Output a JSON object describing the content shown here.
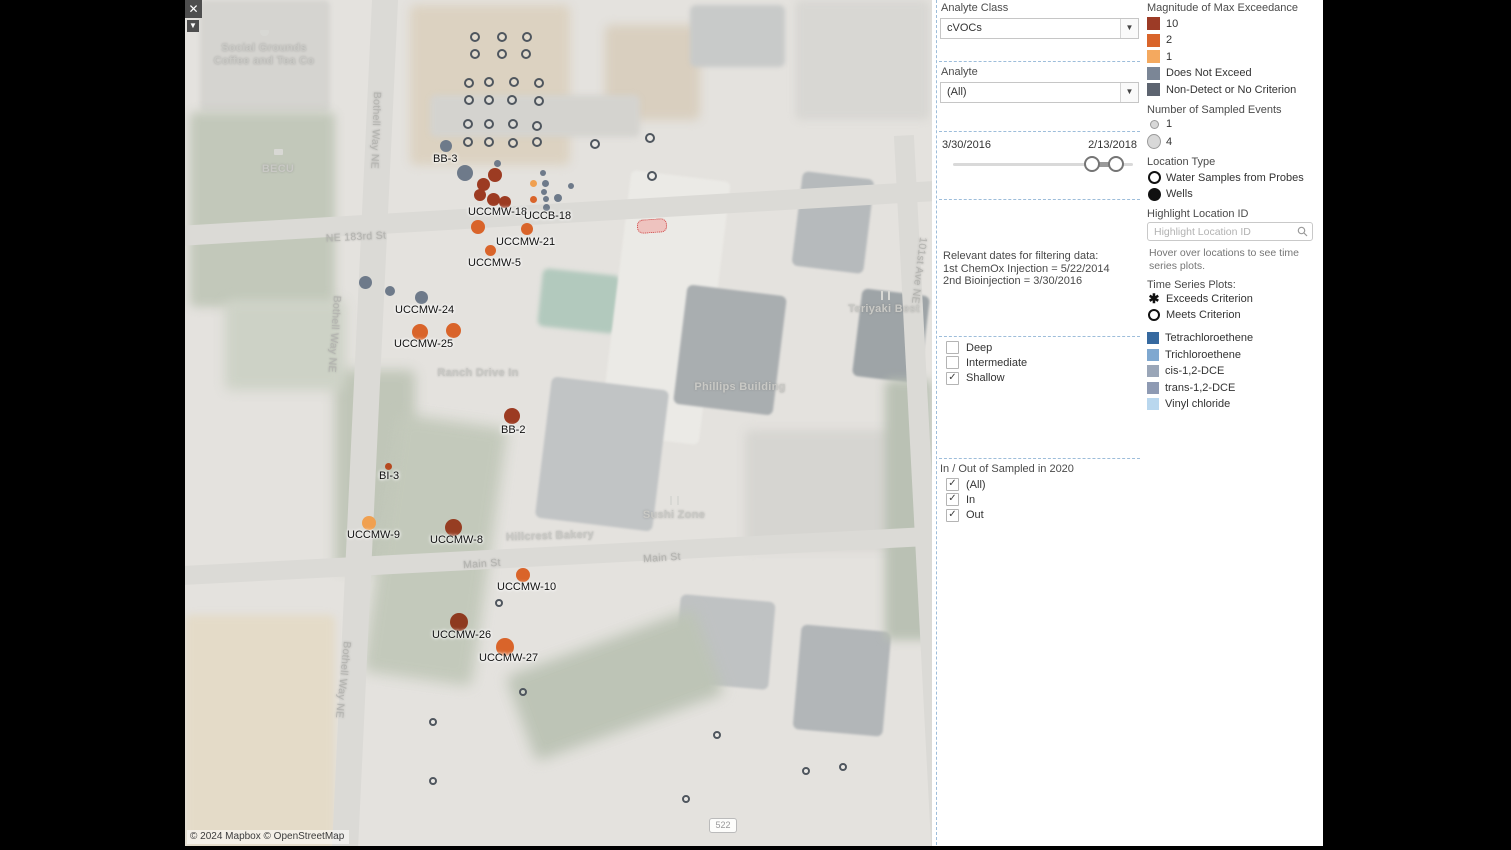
{
  "window": {
    "close_glyph": "✕",
    "caret_glyph": "▼"
  },
  "map": {
    "attribution": "© 2024 Mapbox © OpenStreetMap",
    "route_badge": "522",
    "colors": {
      "exceed10": "#9c3b22",
      "exceed2": "#d9642a",
      "exceed1": "#f0a050",
      "does_not_exceed": "#6e7a8a",
      "probe_ring": "#4f565e"
    },
    "patches": [
      [
        15,
        0,
        130,
        112,
        "#d5d4d0",
        0,
        2
      ],
      [
        5,
        112,
        145,
        195,
        "#c2c8ba",
        0,
        5
      ],
      [
        225,
        5,
        160,
        160,
        "#dcd2c1",
        0,
        5
      ],
      [
        420,
        25,
        95,
        95,
        "#d9cfbf",
        0,
        5
      ],
      [
        505,
        5,
        95,
        62,
        "#c8cac9",
        0,
        2
      ],
      [
        610,
        0,
        135,
        120,
        "#d8d7d3",
        0,
        4
      ],
      [
        245,
        95,
        210,
        42,
        "#d4d3cf",
        0,
        3
      ],
      [
        355,
        272,
        78,
        58,
        "#b2c9bd",
        6,
        2
      ],
      [
        430,
        175,
        100,
        265,
        "#ebeae6",
        7,
        1
      ],
      [
        358,
        383,
        118,
        142,
        "#c1c4c5",
        7,
        1
      ],
      [
        495,
        290,
        100,
        120,
        "#a9aeb0",
        7,
        1
      ],
      [
        612,
        175,
        72,
        95,
        "#b6babc",
        7,
        1
      ],
      [
        672,
        292,
        68,
        88,
        "#9ea4a7",
        7,
        1
      ],
      [
        612,
        628,
        90,
        105,
        "#b2b6b8",
        5,
        1
      ],
      [
        492,
        598,
        95,
        88,
        "#bfc2c3",
        5,
        1
      ],
      [
        0,
        615,
        150,
        235,
        "#e4dbc8",
        0,
        4
      ],
      [
        150,
        370,
        80,
        200,
        "#c0c6b8",
        0,
        6
      ],
      [
        195,
        420,
        110,
        260,
        "#c3c9bb",
        8,
        7
      ],
      [
        40,
        300,
        120,
        90,
        "#cdd2c6",
        0,
        6
      ],
      [
        560,
        430,
        180,
        120,
        "#d6d5d1",
        0,
        5
      ],
      [
        330,
        640,
        200,
        90,
        "#bdc4b6",
        -20,
        7
      ],
      [
        700,
        380,
        47,
        260,
        "#bac1b4",
        0,
        5
      ]
    ],
    "roads": [
      [
        167,
        -25,
        26,
        900,
        2.7
      ],
      [
        -10,
        203,
        780,
        20,
        -3.4
      ],
      [
        -10,
        546,
        780,
        19,
        -3
      ],
      [
        728,
        135,
        20,
        730,
        -3
      ]
    ],
    "labels": [
      [
        "Social Grounds",
        79,
        42,
        0,
        "poi"
      ],
      [
        "Coffee and Tea Co",
        79,
        55,
        0,
        "poi"
      ],
      [
        "BECU",
        93,
        163,
        0,
        "poi"
      ],
      [
        "NE 183rd St",
        171,
        231,
        -3,
        "street"
      ],
      [
        "Ranch Drive In",
        293,
        367,
        0,
        "poi"
      ],
      [
        "Phillips Building",
        555,
        381,
        0,
        "poi"
      ],
      [
        "Teriyaki Best",
        699,
        303,
        0,
        "poi"
      ],
      [
        "Sushi Zone",
        489,
        509,
        0,
        "poi"
      ],
      [
        "Hillcrest Bakery",
        365,
        530,
        -2,
        "poi"
      ],
      [
        "Main St",
        297,
        558,
        -4,
        "street"
      ],
      [
        "Main St",
        477,
        552,
        -4,
        "street"
      ],
      [
        "Bothell Way NE",
        198,
        92,
        92,
        "vstreet"
      ],
      [
        "Bothell Way NE",
        158,
        296,
        94,
        "vstreet"
      ],
      [
        "Bothell Way NE",
        168,
        642,
        96,
        "vstreet"
      ],
      [
        "101st Ave NE",
        744,
        238,
        97,
        "vstreet"
      ]
    ],
    "icons": [
      [
        "cafe",
        75,
        30
      ],
      [
        "bank",
        89,
        149
      ],
      [
        "restaurant",
        485,
        496
      ],
      [
        "restaurant",
        696,
        291
      ]
    ],
    "rings": [
      [
        290,
        37,
        5
      ],
      [
        317,
        37,
        5
      ],
      [
        342,
        37,
        5
      ],
      [
        290,
        54,
        5
      ],
      [
        317,
        54,
        5
      ],
      [
        341,
        54,
        5
      ],
      [
        284,
        83,
        5
      ],
      [
        304,
        82,
        5
      ],
      [
        329,
        82,
        5
      ],
      [
        354,
        83,
        5
      ],
      [
        284,
        100,
        5
      ],
      [
        304,
        100,
        5
      ],
      [
        327,
        100,
        5
      ],
      [
        354,
        101,
        5
      ],
      [
        283,
        124,
        5
      ],
      [
        304,
        124,
        5
      ],
      [
        328,
        124,
        5
      ],
      [
        352,
        126,
        5
      ],
      [
        283,
        142,
        5
      ],
      [
        304,
        142,
        5
      ],
      [
        328,
        143,
        5
      ],
      [
        352,
        142,
        5
      ],
      [
        410,
        144,
        5
      ],
      [
        465,
        138,
        5
      ],
      [
        467,
        176,
        5
      ],
      [
        314,
        603,
        4
      ],
      [
        338,
        692,
        4
      ],
      [
        532,
        735,
        4
      ],
      [
        621,
        771,
        4
      ],
      [
        658,
        767,
        4
      ],
      [
        501,
        799,
        4
      ],
      [
        248,
        722,
        4
      ],
      [
        248,
        781,
        4
      ]
    ],
    "dots": [
      [
        261,
        146,
        6,
        "#6e7a8a"
      ],
      [
        280,
        173,
        8,
        "#6e7a8a"
      ],
      [
        312,
        163,
        3.5,
        "#6e7a8a"
      ],
      [
        358,
        173,
        3,
        "#6e7a8a"
      ],
      [
        360,
        183,
        3.5,
        "#6e7a8a"
      ],
      [
        359,
        192,
        3,
        "#6e7a8a"
      ],
      [
        361,
        199,
        3,
        "#6e7a8a"
      ],
      [
        361,
        207,
        3.5,
        "#6e7a8a"
      ],
      [
        373,
        198,
        4,
        "#6e7a8a"
      ],
      [
        386,
        186,
        3,
        "#6e7a8a"
      ],
      [
        180,
        282,
        6.5,
        "#6e7a8a"
      ],
      [
        205,
        291,
        5,
        "#6e7a8a"
      ],
      [
        236,
        297,
        6.5,
        "#6e7a8a"
      ],
      [
        310,
        175,
        7,
        "#9c3b22"
      ],
      [
        298,
        184,
        6.5,
        "#9c3b22"
      ],
      [
        295,
        195,
        6,
        "#9c3b22"
      ],
      [
        308,
        199,
        6.5,
        "#9c3b22"
      ],
      [
        320,
        202,
        6,
        "#9c3b22"
      ],
      [
        327,
        416,
        8,
        "#9c3b22"
      ],
      [
        268,
        527,
        8.5,
        "#963d22"
      ],
      [
        274,
        622,
        9,
        "#8e3a1f"
      ],
      [
        203,
        466,
        3.5,
        "#b5491f"
      ],
      [
        348,
        183,
        3.5,
        "#f0a050"
      ],
      [
        184,
        523,
        7,
        "#f0a050"
      ],
      [
        348,
        199,
        3.5,
        "#d9642a"
      ],
      [
        293,
        227,
        7,
        "#d9642a"
      ],
      [
        342,
        229,
        6,
        "#d9642a"
      ],
      [
        305,
        250,
        5.5,
        "#d9642a"
      ],
      [
        235,
        332,
        8,
        "#d9642a"
      ],
      [
        268,
        330,
        7.5,
        "#d9642a"
      ],
      [
        338,
        575,
        7,
        "#d9642a"
      ],
      [
        320,
        647,
        9,
        "#d9642a"
      ]
    ],
    "well_labels": [
      [
        "BB-3",
        248,
        153
      ],
      [
        "UCCMW-18",
        283,
        206
      ],
      [
        "UCCB-18",
        339,
        210
      ],
      [
        "UCCMW-21",
        311,
        236
      ],
      [
        "UCCMW-5",
        283,
        257
      ],
      [
        "UCCMW-24",
        210,
        304
      ],
      [
        "UCCMW-25",
        209,
        338
      ],
      [
        "BB-2",
        316,
        424
      ],
      [
        "BI-3",
        194,
        470
      ],
      [
        "UCCMW-9",
        162,
        529
      ],
      [
        "UCCMW-8",
        245,
        534
      ],
      [
        "UCCMW-10",
        312,
        581
      ],
      [
        "UCCMW-26",
        247,
        629
      ],
      [
        "UCCMW-27",
        294,
        652
      ]
    ]
  },
  "filters": {
    "analyte_class": {
      "title": "Analyte Class",
      "value": "cVOCs"
    },
    "analyte": {
      "title": "Analyte",
      "value": "(All)"
    },
    "date_slider": {
      "start": "3/30/2016",
      "end": "2/13/2018"
    },
    "notes": [
      "Relevant dates for filtering data:",
      "1st ChemOx Injection = 5/22/2014",
      "2nd Bioinjection = 3/30/2016"
    ],
    "depth": {
      "items": [
        {
          "label": "Deep",
          "checked": false
        },
        {
          "label": "Intermediate",
          "checked": false
        },
        {
          "label": "Shallow",
          "checked": true
        }
      ]
    },
    "in_out": {
      "title": "In / Out of Sampled in 2020",
      "items": [
        {
          "label": "(All)",
          "checked": true
        },
        {
          "label": "In",
          "checked": true
        },
        {
          "label": "Out",
          "checked": true
        }
      ]
    }
  },
  "legend": {
    "magnitude": {
      "title": "Magnitude of Max Exceedance",
      "items": [
        {
          "label": "10",
          "color": "#9c3b26"
        },
        {
          "label": "2",
          "color": "#d9652b"
        },
        {
          "label": "1",
          "color": "#f4a95f"
        },
        {
          "label": "Does Not Exceed",
          "color": "#7b8696"
        },
        {
          "label": "Non-Detect or No Criterion",
          "color": "#5d6470"
        }
      ]
    },
    "sampled_events": {
      "title": "Number of Sampled Events",
      "items": [
        {
          "label": "1",
          "size": 7
        },
        {
          "label": "4",
          "size": 13
        }
      ]
    },
    "location_type": {
      "title": "Location Type",
      "items": [
        {
          "label": "Water Samples from Probes",
          "style": "open"
        },
        {
          "label": "Wells",
          "style": "filled"
        }
      ]
    },
    "highlight": {
      "title": "Highlight Location ID",
      "placeholder": "Highlight Location ID"
    },
    "hover_note": "Hover over locations to see time series plots.",
    "time_series": {
      "title": "Time Series Plots:",
      "items": [
        {
          "label": "Exceeds Criterion",
          "glyph": "asterisk"
        },
        {
          "label": "Meets Criterion",
          "glyph": "circle"
        }
      ]
    },
    "analytes": [
      {
        "label": "Tetrachloroethene",
        "color": "#36699f"
      },
      {
        "label": "Trichloroethene",
        "color": "#7fa8d0"
      },
      {
        "label": "cis-1,2-DCE",
        "color": "#9aa6b8"
      },
      {
        "label": "trans-1,2-DCE",
        "color": "#8e9ab3"
      },
      {
        "label": "Vinyl chloride",
        "color": "#b9d7ee"
      }
    ]
  }
}
